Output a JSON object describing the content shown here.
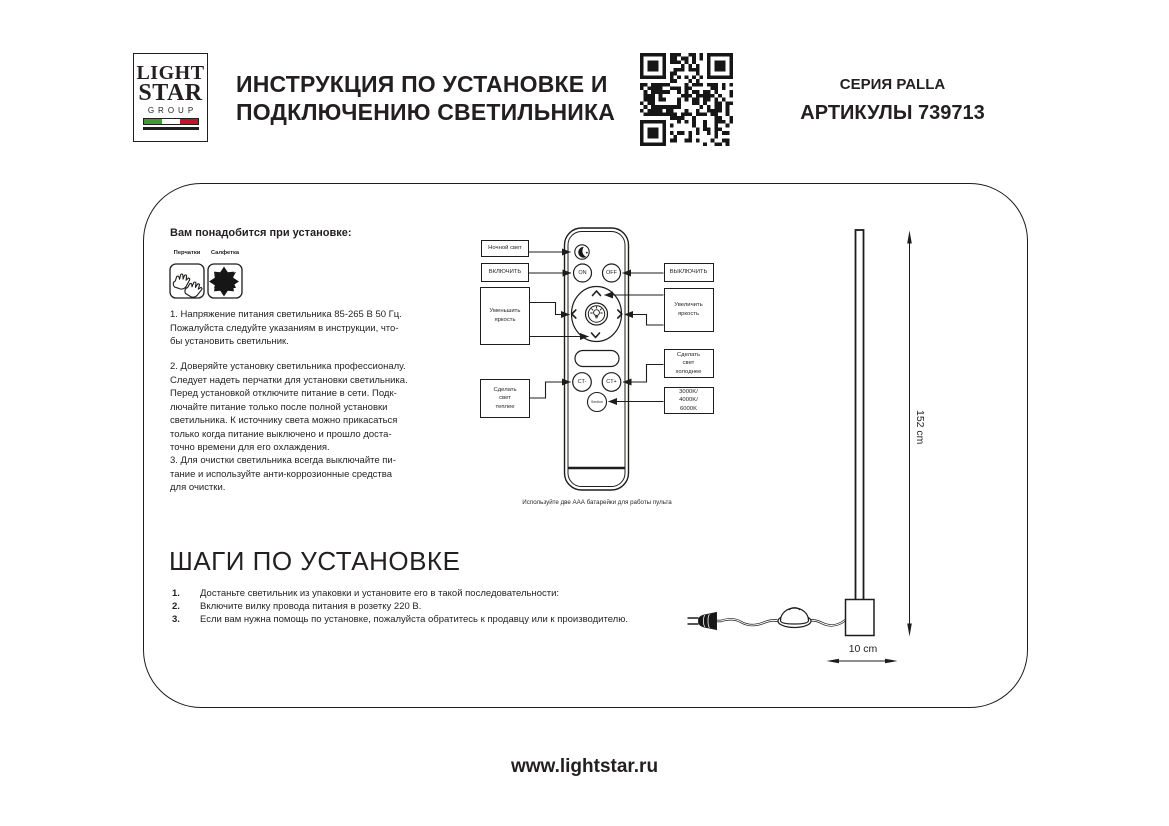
{
  "header": {
    "logo_line1": "LIGHT",
    "logo_line2": "STAR",
    "logo_line3": "GROUP",
    "title_line1": "ИНСТРУКЦИЯ ПО УСТАНОВКЕ И",
    "title_line2": "ПОДКЛЮЧЕНИЮ СВЕТИЛЬНИКА",
    "series": "СЕРИЯ PALLA",
    "articles": "АРТИКУЛЫ 739713"
  },
  "needs": {
    "heading": "Вам понадобится при установке:",
    "item1_label": "Перчатки",
    "item2_label": "Салфетка"
  },
  "paragraphs": {
    "p1": "1. Напряжение питания светильника 85-265 В 50 Гц.\nПожалуйста следуйте указаниям в инструкции, что-\nбы установить светильник.",
    "p2": "2. Доверяйте установку светильника профессионалу.\nСледует надеть перчатки для установки светильника.\nПеред установкой отключите питание в сети. Подк-\nлючайте питание только после полной установки\nсветильника. К источнику света можно прикасаться\nтолько когда питание выключено и прошло доста-\nточно времени для его охлаждения.",
    "p3": "3. Для очистки светильника всегда выключайте пи-\nтание и используйте анти-коррозионные средства\nдля очистки."
  },
  "remote": {
    "callouts": {
      "night": "Ночной свет",
      "turn_on": "ВКЛЮЧИТЬ",
      "turn_off": "ВЫКЛЮЧИТЬ",
      "dim": "Уменьшить\nяркость",
      "brighten": "Увеличить\nяркость",
      "warmer": "Сделать\nсвет\nтеплее",
      "colder": "Сделать\nсвет\nхолоднее",
      "kelvin": "3000K/\n4000K/\n6000K"
    },
    "buttons": {
      "on": "ON",
      "off": "OFF",
      "ct_minus": "CT-",
      "ct_plus": "CT+",
      "section": "Section"
    },
    "caption": "Используйте две ААА батарейки для работы пульта"
  },
  "lamp": {
    "height_label": "152 cm",
    "base_label": "10 cm"
  },
  "steps": {
    "heading": "ШАГИ ПО УСТАНОВКЕ",
    "item1_num": "1.",
    "item1_text": "Достаньте светильник из упаковки и установите его в такой последовательности:",
    "item2_num": "2.",
    "item2_text": "Включите вилку провода питания в розетку 220 В.",
    "item3_num": "3.",
    "item3_text": "Если вам нужна помощь по установке, пожалуйста обратитесь к продавцу или к производителю."
  },
  "footer": {
    "website": "www.lightstar.ru"
  },
  "colors": {
    "ink": "#231f20",
    "flag_green": "#3f9c35",
    "flag_red": "#c8102e"
  }
}
